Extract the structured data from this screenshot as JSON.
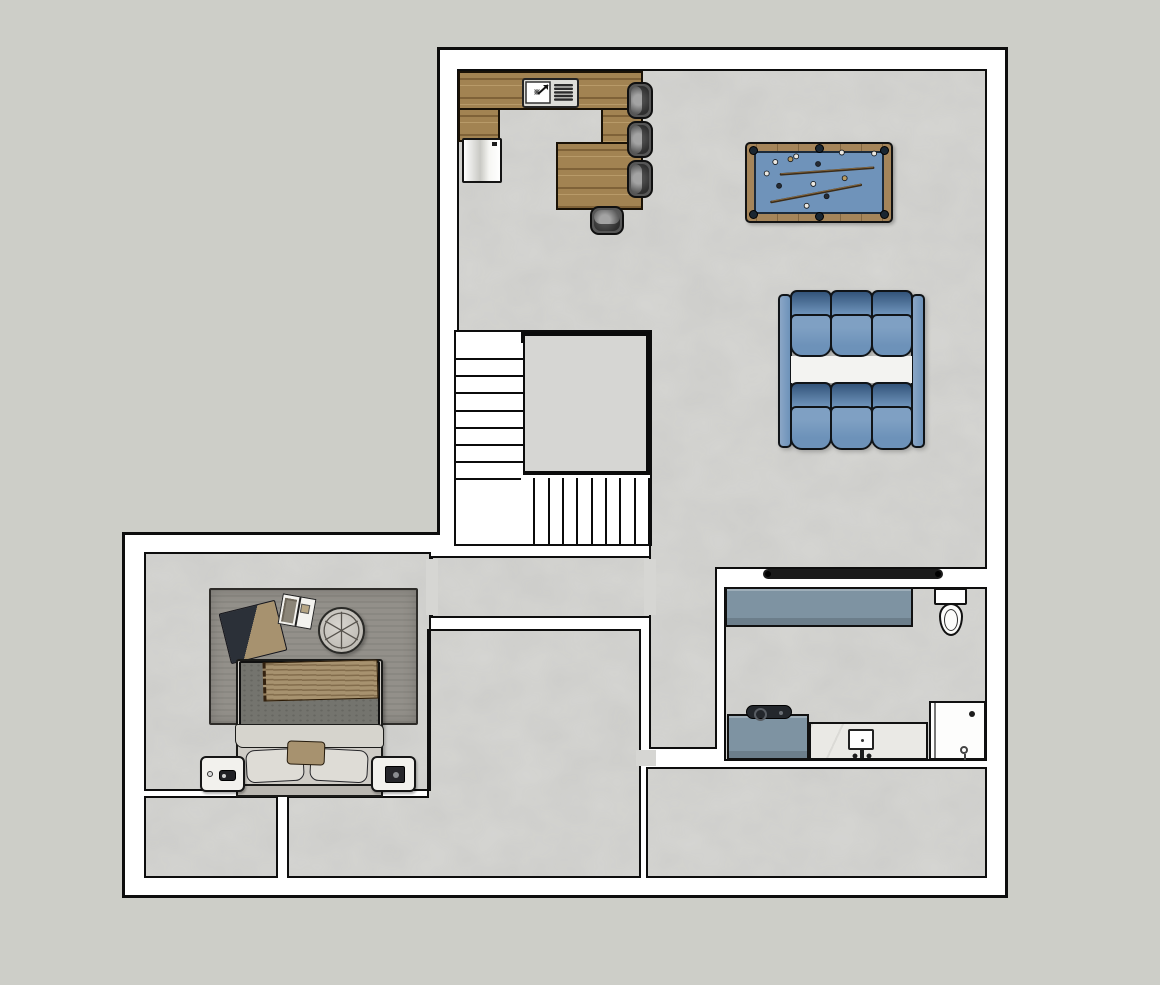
{
  "scene": {
    "description": "Top-down 2D floor plan of a finished basement level with rec room, wet bar, pool table, theater sofas, staircase, bedroom, bathroom and storage rooms",
    "view": "plan-view"
  },
  "colors": {
    "bg": "#cdcec8",
    "line": "#0d0d0d",
    "wall": "#ffffff",
    "floor": "#d6d6d3",
    "wood": "#a28352",
    "rail": "#a5855a",
    "felt": "#6f93ba",
    "pocket": "#1a2631",
    "sofa": "#6d92b9",
    "sofa-dark": "#33547a",
    "cabinet": "#7e93a2",
    "marble": "#eae9e5",
    "tv": "#1b1b1b",
    "rug": "#93908a",
    "blanket": "#2b3038",
    "tan": "#a7926f",
    "duvet": "#74746e",
    "sheet": "#d6d4cd",
    "pillow": "#dedcd6",
    "bedframe": "#cfccc6",
    "headboard": "#bab7b1"
  },
  "stairs": {
    "upper_steps": 8,
    "lower_steps": 9
  },
  "kitchen": {
    "items": [
      "l-shaped-bar-counter",
      "sink-with-drainboard",
      "refrigerator"
    ],
    "stools": [
      {
        "x": 627,
        "y": 82,
        "w": 26,
        "h": 37,
        "back": "right"
      },
      {
        "x": 627,
        "y": 121,
        "w": 26,
        "h": 37,
        "back": "right"
      },
      {
        "x": 627,
        "y": 160,
        "w": 26,
        "h": 38,
        "back": "right"
      },
      {
        "x": 590,
        "y": 206,
        "w": 34,
        "h": 29,
        "back": "bottom"
      }
    ]
  },
  "pool_table": {
    "balls": [
      {
        "x": 28,
        "y": 19,
        "shade": "light"
      },
      {
        "x": 44,
        "y": 16,
        "shade": "tan"
      },
      {
        "x": 50,
        "y": 13,
        "shade": "light"
      },
      {
        "x": 73,
        "y": 21,
        "shade": "dark"
      },
      {
        "x": 98,
        "y": 9,
        "shade": "light"
      },
      {
        "x": 132,
        "y": 10,
        "shade": "light"
      },
      {
        "x": 19,
        "y": 31,
        "shade": "light"
      },
      {
        "x": 32,
        "y": 44,
        "shade": "dark"
      },
      {
        "x": 68,
        "y": 42,
        "shade": "light"
      },
      {
        "x": 101,
        "y": 36,
        "shade": "tan"
      },
      {
        "x": 82,
        "y": 55,
        "shade": "dark"
      },
      {
        "x": 61,
        "y": 65,
        "shade": "light"
      }
    ],
    "cues": [
      {
        "x1": 34,
        "y1": 32,
        "x2": 131,
        "y2": 25
      },
      {
        "x1": 24,
        "y1": 61,
        "x2": 118,
        "y2": 43
      }
    ]
  },
  "sofa": {
    "rows": 2,
    "seats_per_row": 3
  },
  "bathroom": {
    "items": [
      "wall-mounted-tv",
      "storage-cabinet",
      "toilet",
      "low-cabinet-with-record-player",
      "marble-vanity-sink",
      "shower"
    ]
  },
  "bedroom": {
    "items": [
      "area-rug",
      "folded-blanket",
      "open-book",
      "round-tufted-ottoman",
      "double-bed",
      "nightstand-left",
      "nightstand-right"
    ]
  }
}
